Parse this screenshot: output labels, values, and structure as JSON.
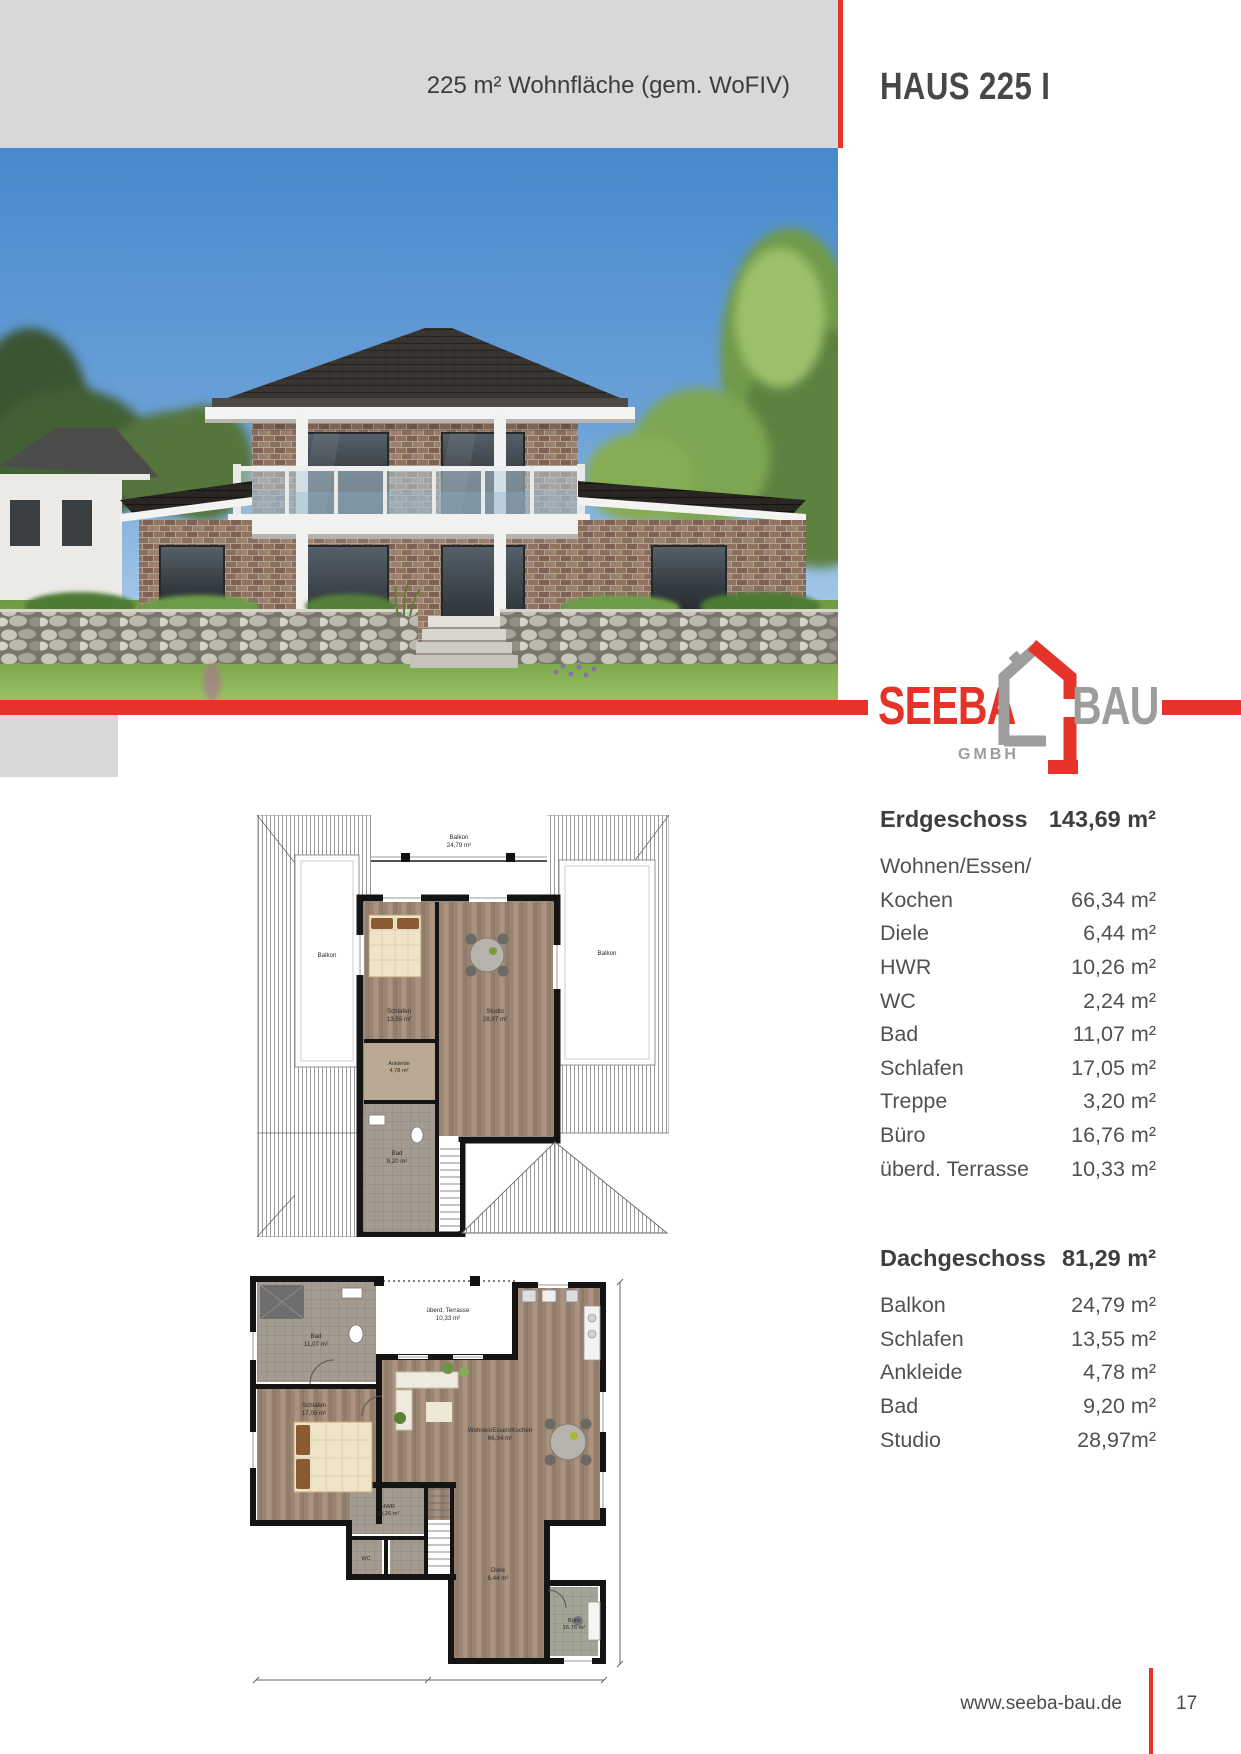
{
  "colors": {
    "red": "#e63229",
    "gray_block": "#d8d8d8",
    "logo_gray": "#9d9d9c",
    "text_dark": "#3e3e3e"
  },
  "header": {
    "area_note": "225 m² Wohnfläche (gem. WoFIV)",
    "title": "HAUS 225 I"
  },
  "logo": {
    "word1": "SEEBA",
    "word2": "BAU",
    "sub": "GMBH"
  },
  "floor_tables": [
    {
      "title": "Erdgeschoss",
      "total": "143,69 m²",
      "rows": [
        [
          "Wohnen/Essen/",
          ""
        ],
        [
          "Kochen",
          "66,34 m²"
        ],
        [
          "Diele",
          "6,44 m²"
        ],
        [
          "HWR",
          "10,26 m²"
        ],
        [
          "WC",
          "2,24 m²"
        ],
        [
          "Bad",
          "11,07 m²"
        ],
        [
          "Schlafen",
          "17,05 m²"
        ],
        [
          "Treppe",
          "3,20 m²"
        ],
        [
          "Büro",
          "16,76 m²"
        ],
        [
          "überd. Terrasse",
          "10,33 m²"
        ]
      ]
    },
    {
      "title": "Dachgeschoss",
      "total": "81,29 m²",
      "rows": [
        [
          "Balkon",
          "24,79 m²"
        ],
        [
          "Schlafen",
          "13,55 m²"
        ],
        [
          "Ankleide",
          "4,78 m²"
        ],
        [
          "Bad",
          "9,20 m²"
        ],
        [
          "Studio",
          "28,97m²"
        ]
      ]
    }
  ],
  "plans": {
    "upper": {
      "rooms": [
        {
          "name": "Balkon",
          "area": "24,79 m²"
        },
        {
          "name": "Balkon",
          "area": ""
        },
        {
          "name": "Balkon",
          "area": ""
        },
        {
          "name": "Schlafen",
          "area": "13,55 m²"
        },
        {
          "name": "Studio",
          "area": "28,97 m²"
        },
        {
          "name": "Ankleide",
          "area": "4,78 m²"
        },
        {
          "name": "Bad",
          "area": "9,20 m²"
        }
      ]
    },
    "ground": {
      "rooms": [
        {
          "name": "überd. Terrasse",
          "area": "10,33 m²"
        },
        {
          "name": "Wohnen/Essen/Kochen",
          "area": "66,34 m²"
        },
        {
          "name": "Schlafen",
          "area": "17,05 m²"
        },
        {
          "name": "Bad",
          "area": "11,07 m²"
        },
        {
          "name": "HWR",
          "area": "10,26 m²"
        },
        {
          "name": "WC",
          "area": "2,24 m²"
        },
        {
          "name": "Diele",
          "area": "6,44 m²"
        },
        {
          "name": "Büro",
          "area": "16,76 m²"
        }
      ]
    }
  },
  "footer": {
    "url": "www.seeba-bau.de",
    "page_number": "17"
  }
}
